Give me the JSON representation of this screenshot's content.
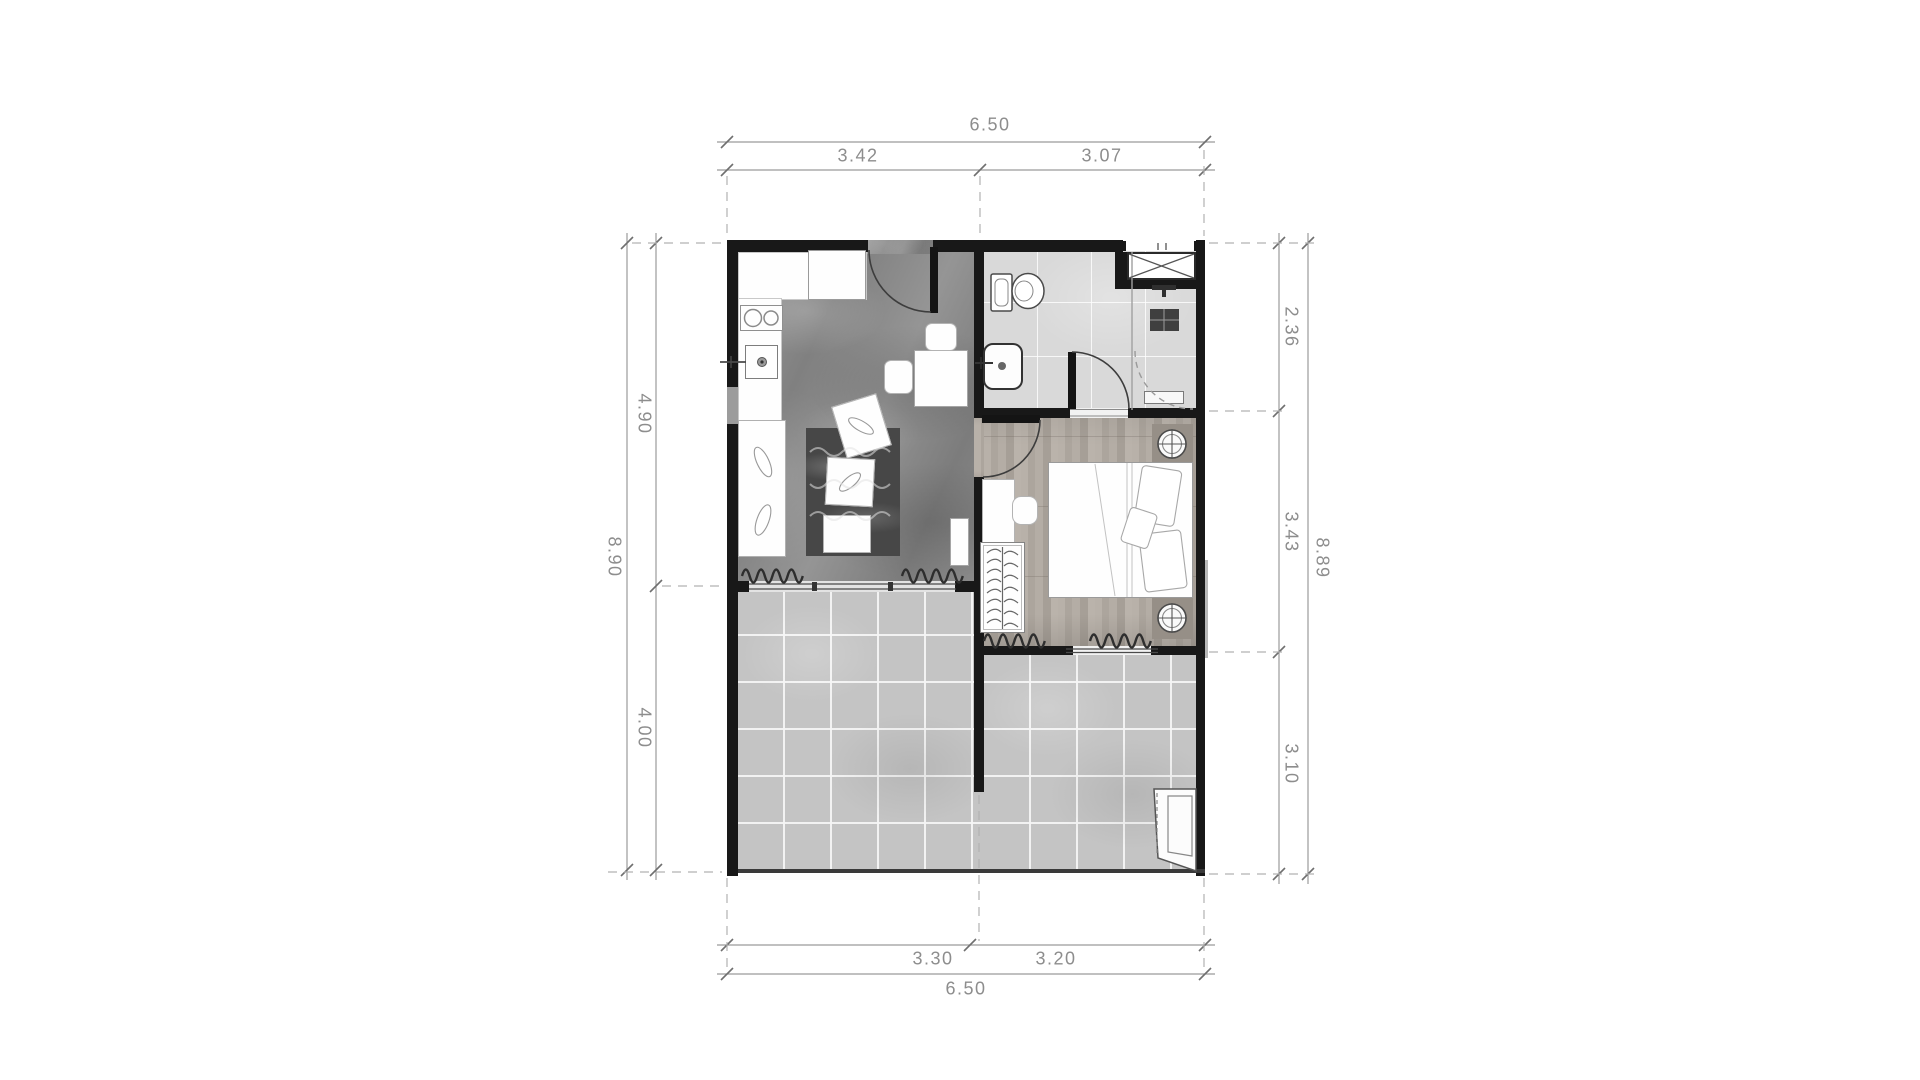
{
  "plan": {
    "dimensions": {
      "top": {
        "total": "6.50",
        "segments": [
          "3.42",
          "3.07"
        ]
      },
      "bottom": {
        "total": "6.50",
        "segments": [
          "3.30",
          "3.20"
        ]
      },
      "left": {
        "total": "8.90",
        "segments": [
          "4.90",
          "4.00"
        ]
      },
      "right": {
        "total": "8.89",
        "segments": [
          "2.36",
          "3.43",
          "3.10"
        ]
      }
    },
    "colors": {
      "wall": "#181818",
      "dimension_text": "#8d8d8d",
      "dimension_line": "#9b9b9b",
      "floor_living_marble": "#8e8e8e",
      "floor_bathroom_tile": "#d9d9d9",
      "floor_bedroom_wood": "#b1aaa2",
      "floor_terrace_tile": "#c4c4c4",
      "furniture": "#fefefe",
      "rug": "#474747"
    }
  }
}
